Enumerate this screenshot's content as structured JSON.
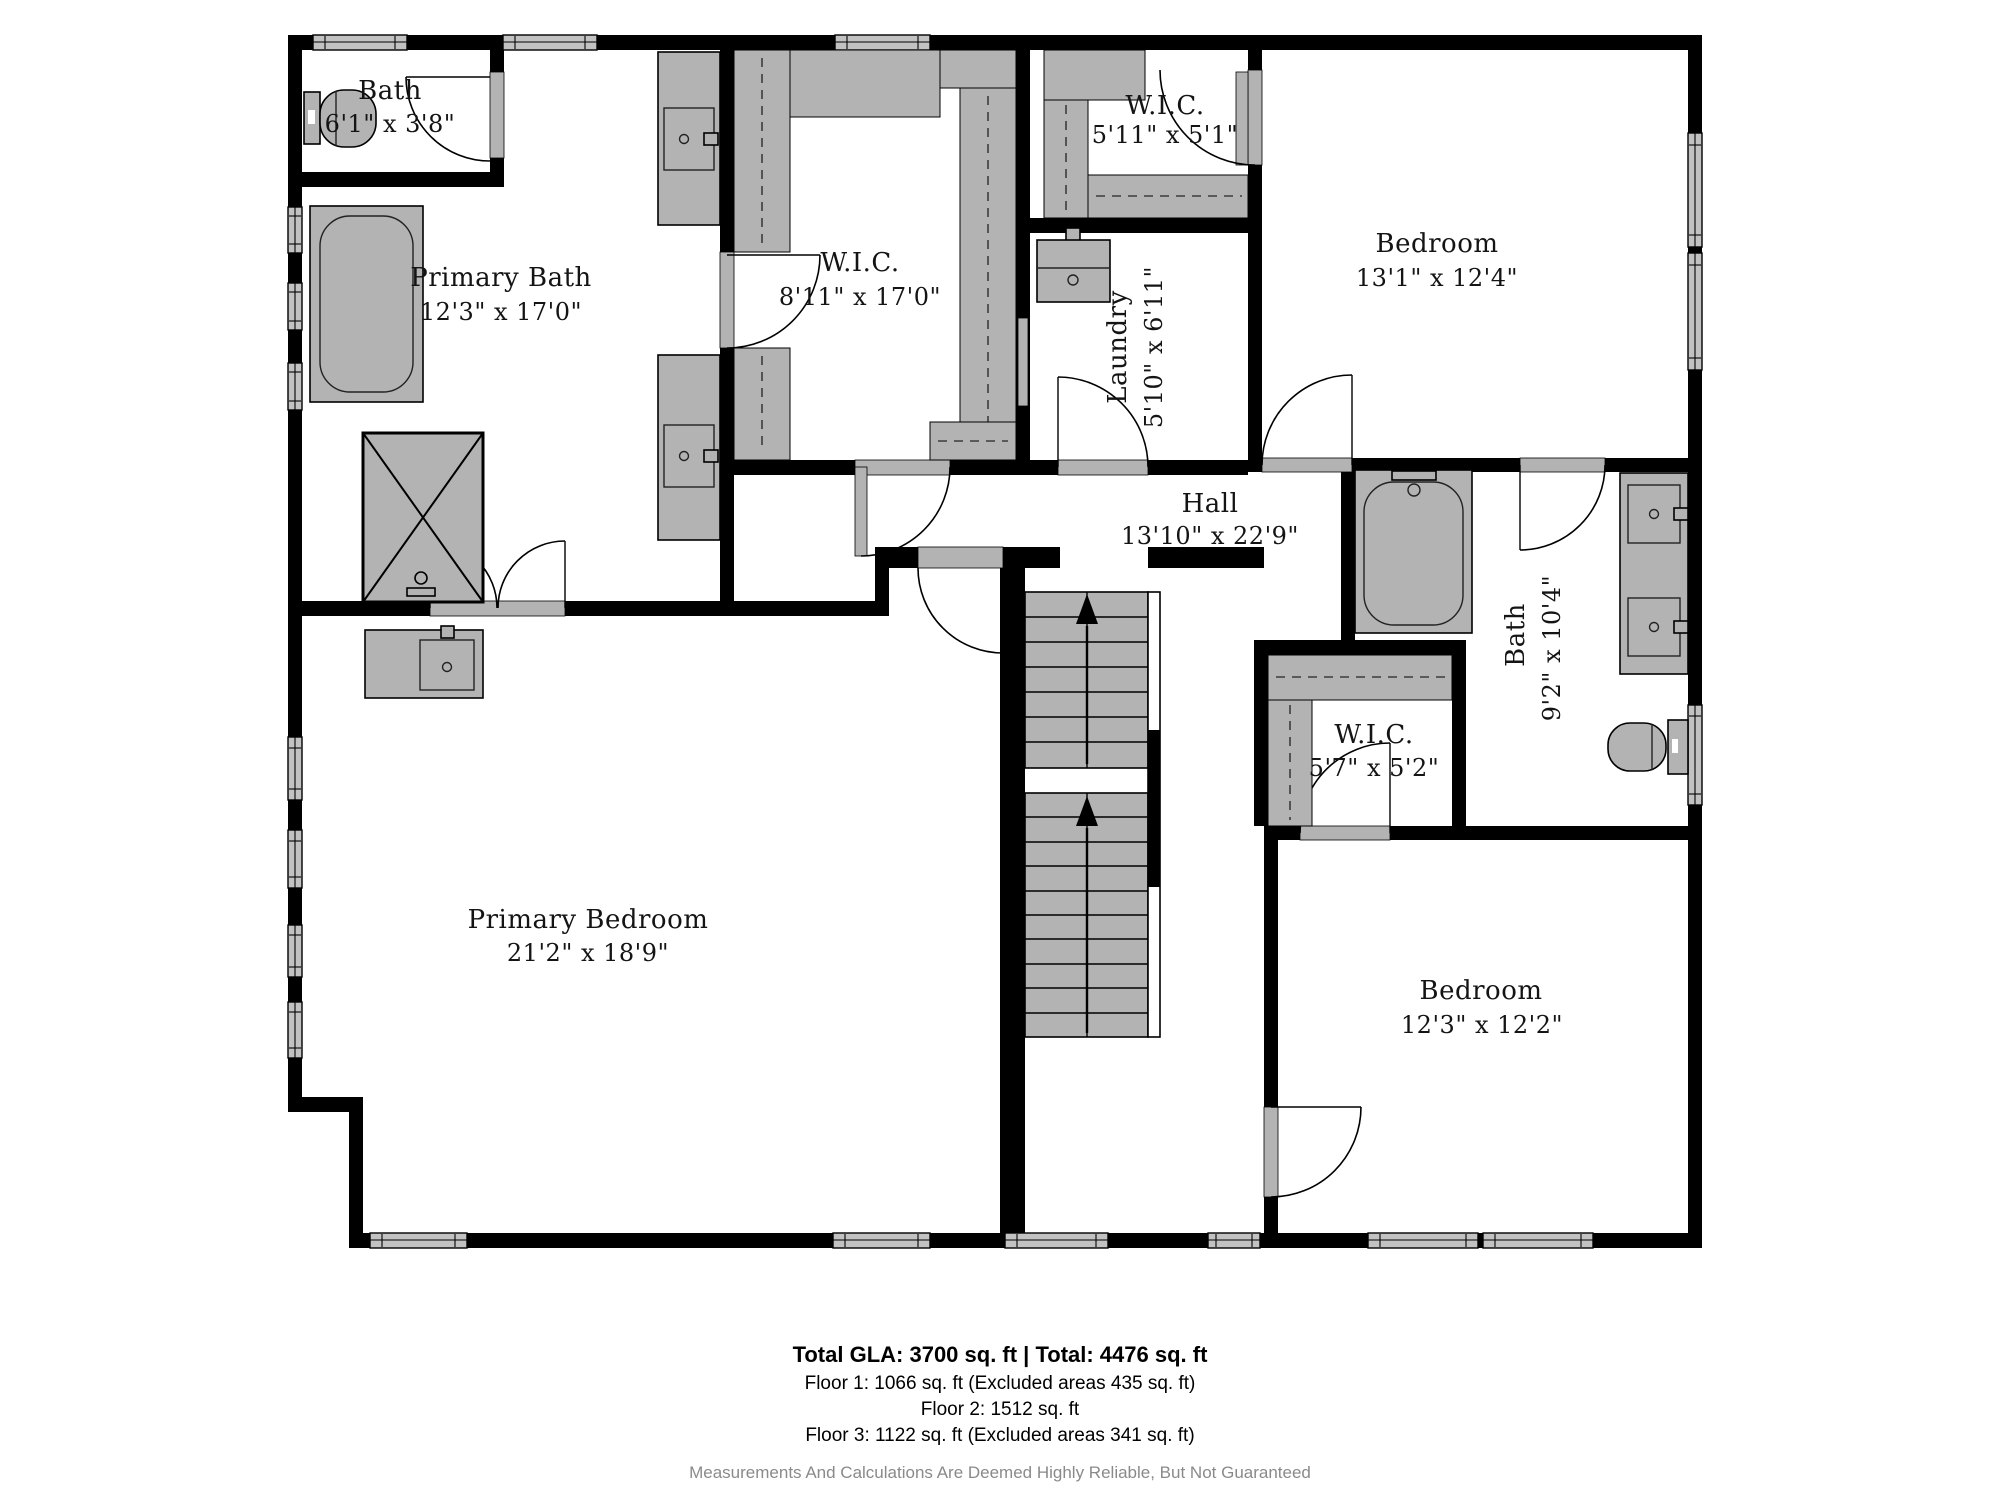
{
  "plan": {
    "rooms": [
      {
        "name": "Bath",
        "dims": "6'1\" x 3'8\""
      },
      {
        "name": "Primary Bath",
        "dims": "12'3\" x 17'0\""
      },
      {
        "name": "W.I.C.",
        "dims": "8'11\" x 17'0\""
      },
      {
        "name": "W.I.C.",
        "dims": "5'11\" x 5'1\""
      },
      {
        "name": "Laundry",
        "dims": "5'10\" x 6'11\""
      },
      {
        "name": "Bedroom",
        "dims": "13'1\" x 12'4\""
      },
      {
        "name": "Hall",
        "dims": "13'10\" x 22'9\""
      },
      {
        "name": "Bath",
        "dims": "9'2\" x 10'4\""
      },
      {
        "name": "W.I.C.",
        "dims": "5'7\" x 5'2\""
      },
      {
        "name": "Primary Bedroom",
        "dims": "21'2\" x 18'9\""
      },
      {
        "name": "Bedroom",
        "dims": "12'3\" x 12'2\""
      }
    ],
    "colors": {
      "wall": "#000000",
      "fixture": "#b3b3b3",
      "window": "#c2c2c2"
    }
  },
  "footer": {
    "total_line": "Total GLA: 3700 sq. ft | Total: 4476 sq. ft",
    "floor1": "Floor 1: 1066 sq. ft (Excluded areas 435 sq. ft)",
    "floor2": "Floor 2: 1512 sq. ft",
    "floor3": "Floor 3: 1122 sq. ft (Excluded areas 341 sq. ft)",
    "disclaimer": "Measurements And Calculations Are Deemed Highly Reliable, But Not Guaranteed"
  }
}
